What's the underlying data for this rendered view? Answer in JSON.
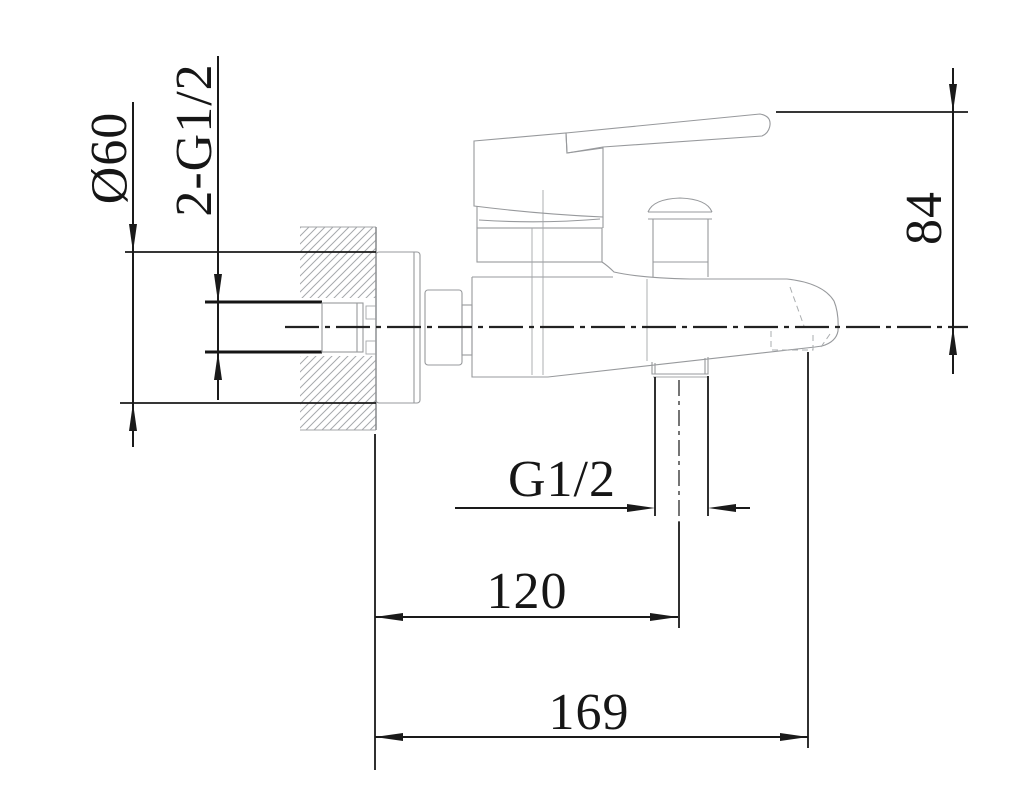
{
  "diagram": {
    "labels": {
      "flange_diameter": "Ø60",
      "wall_connections": "2-G1/2",
      "spout_height": "84",
      "diverter_thread": "G1/2",
      "wall_to_diverter": "120",
      "wall_to_spout_tip": "169"
    },
    "colors": {
      "background": "#ffffff",
      "outline_gray": "#97999c",
      "dimension_black": "#1a1a1a",
      "hatch_gray": "#a6a9ac"
    }
  }
}
